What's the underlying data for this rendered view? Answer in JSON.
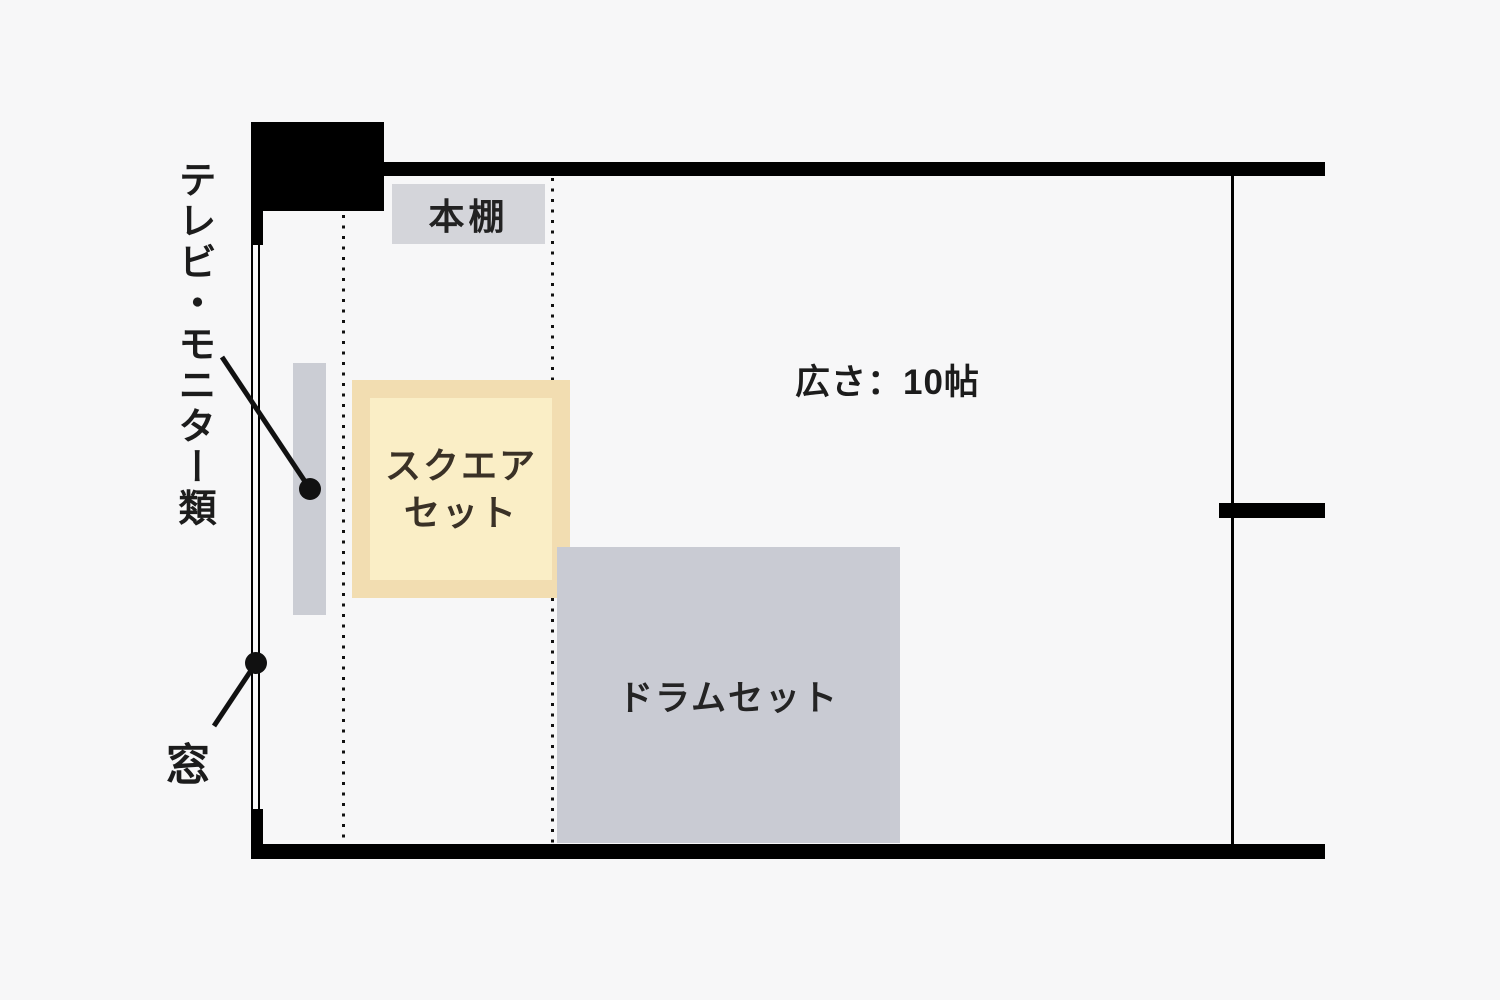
{
  "page": {
    "background": "#f7f7f8",
    "wall_color": "#000000"
  },
  "floor_plan": {
    "room_size_label": "広さ：10帖",
    "external_labels": {
      "tv_monitor": "テレビ・モニター類",
      "window": "窓"
    },
    "furniture": {
      "bookshelf": {
        "label": "本棚",
        "fill": "#d4d5da"
      },
      "tv_monitor_unit": {
        "fill": "#cbcdd4"
      },
      "square_set": {
        "label_line1": "スクエア",
        "label_line2": "セット",
        "outer_fill": "#f2ddb1",
        "inner_fill": "#faeec6",
        "text_color": "#3a3126"
      },
      "drum_set": {
        "label": "ドラムセット",
        "fill": "#c9cbd3"
      }
    }
  }
}
